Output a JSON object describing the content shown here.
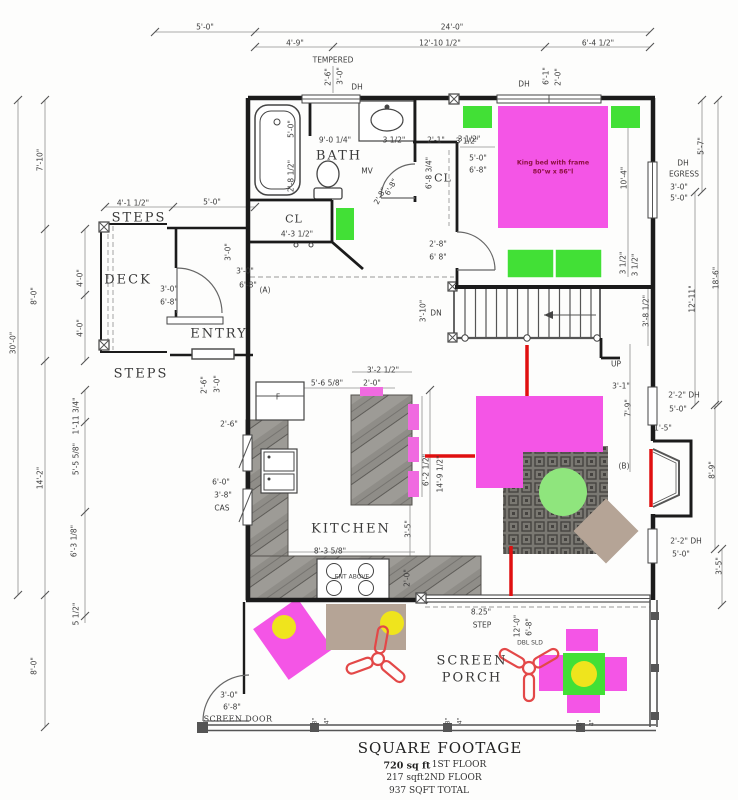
{
  "drawing_type": "first floor plan",
  "colors": {
    "wall": "#1b1b1b",
    "magenta": "#f455e6",
    "pink": "#f06ae0",
    "green": "#42e036",
    "lightgreen": "#8fe57d",
    "yellow": "#efe41d",
    "tan": "#b5a496",
    "red": "#e01010",
    "fanred": "#e34848",
    "dim_text": "#3b3b3b"
  },
  "footer": {
    "title": "SQUARE FOOTAGE",
    "line1_value": "720 sq ft",
    "line1_name": "1ST FLOOR",
    "line2_value": "217 sqft",
    "line2_name": "2ND FLOOR",
    "line3": "937 SQFT TOTAL"
  },
  "bed_note": {
    "line1": "King bed with frame",
    "line2": "80\"w x 86\"l"
  },
  "labels": [
    {
      "t": "5'-0\"",
      "x": 205,
      "y": 27
    },
    {
      "t": "24'-0\"",
      "x": 452,
      "y": 27
    },
    {
      "t": "4'-9\"",
      "x": 295,
      "y": 43
    },
    {
      "t": "12'-10 1/2\"",
      "x": 440,
      "y": 43
    },
    {
      "t": "6'-4 1/2\"",
      "x": 598,
      "y": 43
    },
    {
      "t": "TEMPERED",
      "x": 333,
      "y": 60
    },
    {
      "t": "2'-6\"",
      "x": 328,
      "y": 77,
      "r": -90
    },
    {
      "t": "3'-0\"",
      "x": 340,
      "y": 76,
      "r": -90
    },
    {
      "t": "DH",
      "x": 357,
      "y": 87
    },
    {
      "t": "DH",
      "x": 524,
      "y": 84
    },
    {
      "t": "6'-1\"",
      "x": 546,
      "y": 76,
      "r": -90
    },
    {
      "t": "2'-0\"",
      "x": 558,
      "y": 77,
      "r": -90
    },
    {
      "t": "7'-10\"",
      "x": 40,
      "y": 160,
      "r": -90
    },
    {
      "t": "8'-0\"",
      "x": 34,
      "y": 296,
      "r": -90
    },
    {
      "t": "4'-0\"",
      "x": 80,
      "y": 278,
      "r": -90
    },
    {
      "t": "4'-0\"",
      "x": 80,
      "y": 328,
      "r": -90
    },
    {
      "t": "30'-0\"",
      "x": 13,
      "y": 343,
      "r": -90
    },
    {
      "t": "14'-2\"",
      "x": 40,
      "y": 478,
      "r": -90
    },
    {
      "t": "1'-11 3/4\"",
      "x": 76,
      "y": 416,
      "r": -90
    },
    {
      "t": "5'-5 5/8\"",
      "x": 76,
      "y": 459,
      "r": -90
    },
    {
      "t": "6'-3 1/8\"",
      "x": 74,
      "y": 541,
      "r": -90
    },
    {
      "t": "5 1/2\"",
      "x": 76,
      "y": 614,
      "r": -90
    },
    {
      "t": "8'-0\"",
      "x": 34,
      "y": 666,
      "r": -90
    },
    {
      "t": "5'-7\"",
      "x": 701,
      "y": 146,
      "r": -90
    },
    {
      "t": "DH",
      "x": 683,
      "y": 163
    },
    {
      "t": "EGRESS",
      "x": 684,
      "y": 174
    },
    {
      "t": "3'-0\"",
      "x": 679,
      "y": 187
    },
    {
      "t": "5'-0\"",
      "x": 679,
      "y": 198
    },
    {
      "t": "18'-6\"",
      "x": 716,
      "y": 278,
      "r": -90
    },
    {
      "t": "12'-11\"",
      "x": 692,
      "y": 299,
      "r": -90
    },
    {
      "t": "10'-4\"",
      "x": 624,
      "y": 178,
      "r": -90
    },
    {
      "t": "3 1/2\"",
      "x": 635,
      "y": 265,
      "r": -90
    },
    {
      "t": "3'-8 1/2\"",
      "x": 646,
      "y": 311,
      "r": -90
    },
    {
      "t": "UP",
      "x": 616,
      "y": 364
    },
    {
      "t": "3'-1\"",
      "x": 621,
      "y": 386
    },
    {
      "t": "7'-9\"",
      "x": 628,
      "y": 408,
      "r": -90
    },
    {
      "t": "2'-2\" DH",
      "x": 684,
      "y": 395
    },
    {
      "t": "5'-0\"",
      "x": 678,
      "y": 409
    },
    {
      "t": "1'-5\"",
      "x": 663,
      "y": 428
    },
    {
      "t": "(B)",
      "x": 624,
      "y": 466
    },
    {
      "t": "8'-9\"",
      "x": 712,
      "y": 470,
      "r": -90
    },
    {
      "t": "2'-2\" DH",
      "x": 686,
      "y": 541
    },
    {
      "t": "5'-0\"",
      "x": 681,
      "y": 554
    },
    {
      "t": "3'-5\"",
      "x": 719,
      "y": 566,
      "r": -90
    },
    {
      "t": "5'-0\"",
      "x": 291,
      "y": 129,
      "r": -90
    },
    {
      "t": "9'-0 1/4\"",
      "x": 335,
      "y": 140
    },
    {
      "t": "3 1/2\"",
      "x": 394,
      "y": 140
    },
    {
      "t": "2'-1\"",
      "x": 436,
      "y": 140
    },
    {
      "t": "3 1/2\"",
      "x": 469,
      "y": 139
    },
    {
      "t": "2'-8 1/2\"",
      "x": 291,
      "y": 176,
      "r": -90
    },
    {
      "t": "MV",
      "x": 367,
      "y": 171
    },
    {
      "t": "4'-3 1/2\"",
      "x": 297,
      "y": 234
    },
    {
      "t": "6'-8 3/4\"",
      "x": 429,
      "y": 173,
      "r": -90
    },
    {
      "t": "2'-8\"",
      "x": 380,
      "y": 196,
      "r": -62
    },
    {
      "t": "6'-8\"",
      "x": 391,
      "y": 187,
      "r": -62
    },
    {
      "t": "3 1/2\"",
      "x": 467,
      "y": 141
    },
    {
      "t": "5'-0\"",
      "x": 478,
      "y": 158
    },
    {
      "t": "6'-8\"",
      "x": 478,
      "y": 170
    },
    {
      "t": "2'-8\"",
      "x": 438,
      "y": 244
    },
    {
      "t": "6' 8\"",
      "x": 438,
      "y": 257
    },
    {
      "t": "3 1/2\"",
      "x": 623,
      "y": 263,
      "r": -90
    },
    {
      "t": "4'-1 1/2\"",
      "x": 133,
      "y": 203
    },
    {
      "t": "5'-0\"",
      "x": 212,
      "y": 202
    },
    {
      "t": "3'-0\"",
      "x": 228,
      "y": 252,
      "r": -90
    },
    {
      "t": "3'-0\"",
      "x": 245,
      "y": 271
    },
    {
      "t": "6'-8\"",
      "x": 248,
      "y": 285
    },
    {
      "t": "(A)",
      "x": 265,
      "y": 290
    },
    {
      "t": "3'-0\"",
      "x": 169,
      "y": 289
    },
    {
      "t": "6'-8\"",
      "x": 169,
      "y": 302
    },
    {
      "t": "2'-6\"",
      "x": 204,
      "y": 385,
      "r": -90
    },
    {
      "t": "3'-0\"",
      "x": 217,
      "y": 384,
      "r": -90
    },
    {
      "t": "2'-6\"",
      "x": 229,
      "y": 424
    },
    {
      "t": "F",
      "x": 278,
      "y": 397
    },
    {
      "t": "6'-0\"",
      "x": 221,
      "y": 482
    },
    {
      "t": "3'-8\"",
      "x": 223,
      "y": 495
    },
    {
      "t": "CAS",
      "x": 222,
      "y": 508
    },
    {
      "t": "5'-6 5/8\"",
      "x": 327,
      "y": 383
    },
    {
      "t": "3'-2 1/2\"",
      "x": 383,
      "y": 370
    },
    {
      "t": "2'-0\"",
      "x": 372,
      "y": 383
    },
    {
      "t": "6'-2 1/2\"",
      "x": 426,
      "y": 470,
      "r": -90
    },
    {
      "t": "14'-9 1/2\"",
      "x": 440,
      "y": 474,
      "r": -90
    },
    {
      "t": "3'-5\"",
      "x": 408,
      "y": 529,
      "r": -90
    },
    {
      "t": "8'-3 5/8\"",
      "x": 330,
      "y": 551
    },
    {
      "t": "2'-0\"",
      "x": 407,
      "y": 578,
      "r": -90
    },
    {
      "t": "DN",
      "x": 436,
      "y": 313
    },
    {
      "t": "3'-10\"",
      "x": 423,
      "y": 311,
      "r": -90
    },
    {
      "t": "8.25\"",
      "x": 481,
      "y": 612
    },
    {
      "t": "STEP",
      "x": 482,
      "y": 625
    },
    {
      "t": "12'-0\"",
      "x": 517,
      "y": 626,
      "r": -90
    },
    {
      "t": "6'-8\"",
      "x": 529,
      "y": 627,
      "r": -90
    },
    {
      "t": "DBL SLD",
      "x": 530,
      "y": 643,
      "c": "tiny"
    },
    {
      "t": "3'-0\"",
      "x": 229,
      "y": 695
    },
    {
      "t": "6'-8\"",
      "x": 232,
      "y": 707
    },
    {
      "t": "8\"",
      "x": 315,
      "y": 721,
      "r": -90,
      "c": "tiny"
    },
    {
      "t": "4\"",
      "x": 327,
      "y": 721,
      "r": -90,
      "c": "tiny"
    },
    {
      "t": "8\"",
      "x": 448,
      "y": 721,
      "r": -90,
      "c": "tiny"
    },
    {
      "t": "4\"",
      "x": 460,
      "y": 721,
      "r": -90,
      "c": "tiny"
    },
    {
      "t": "8\"",
      "x": 580,
      "y": 723,
      "r": -90,
      "c": "tiny"
    },
    {
      "t": "4\"",
      "x": 592,
      "y": 723,
      "r": -90,
      "c": "tiny"
    },
    {
      "t": "ENT ABOVE",
      "x": 352,
      "y": 577,
      "c": "tiny"
    },
    {
      "t": "BATH",
      "x": 339,
      "y": 156,
      "c": "room",
      "n": "room-label-bath"
    },
    {
      "t": "CL",
      "x": 294,
      "y": 219,
      "c": "room-sm",
      "n": "room-label-closet-1"
    },
    {
      "t": "CL",
      "x": 443,
      "y": 178,
      "c": "room-sm",
      "n": "room-label-closet-2"
    },
    {
      "t": "DECK",
      "x": 128,
      "y": 280,
      "c": "room",
      "n": "room-label-deck"
    },
    {
      "t": "ENTRY",
      "x": 219,
      "y": 334,
      "c": "room",
      "n": "room-label-entry"
    },
    {
      "t": "STEPS",
      "x": 139,
      "y": 218,
      "c": "room",
      "n": "room-label-steps-top"
    },
    {
      "t": "STEPS",
      "x": 141,
      "y": 374,
      "c": "room",
      "n": "room-label-steps-bottom"
    },
    {
      "t": "KITCHEN",
      "x": 351,
      "y": 529,
      "c": "room",
      "n": "room-label-kitchen"
    },
    {
      "t": "SCREEN",
      "x": 472,
      "y": 661,
      "c": "room",
      "n": "room-label-screen-porch"
    },
    {
      "t": "PORCH",
      "x": 472,
      "y": 678,
      "c": "room",
      "n": "room-label-screen-porch"
    },
    {
      "t": "SCREEN DOOR",
      "x": 238,
      "y": 719,
      "c": "room-xs",
      "n": "screen-door-label"
    }
  ]
}
